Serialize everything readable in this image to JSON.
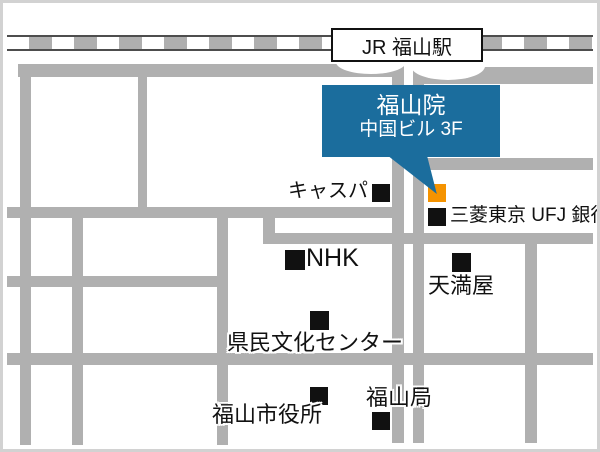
{
  "station": {
    "label": "JR 福山駅"
  },
  "callout": {
    "name": "福山院",
    "building": "中国ビル 3F"
  },
  "landmarks": [
    {
      "id": "caspa",
      "label": "キャスパ"
    },
    {
      "id": "mitsubishi-tokyo-ufj-bank",
      "label": "三菱東京 UFJ 銀行"
    },
    {
      "id": "nhk",
      "label": "NHK"
    },
    {
      "id": "tenmaya",
      "label": "天満屋"
    },
    {
      "id": "kenmin-bunka-center",
      "label": "県民文化センター"
    },
    {
      "id": "fukuyama-city-hall",
      "label": "福山市役所"
    },
    {
      "id": "fukuyama-kyoku",
      "label": "福山局"
    }
  ],
  "colors": {
    "accent_blue": "#1b6d9d",
    "marker_orange": "#f59300",
    "road_gray": "#b0b0b0",
    "rail_dark": "#4d4d4d",
    "frame_gray": "#d2d2d2",
    "label_black": "#111111"
  }
}
